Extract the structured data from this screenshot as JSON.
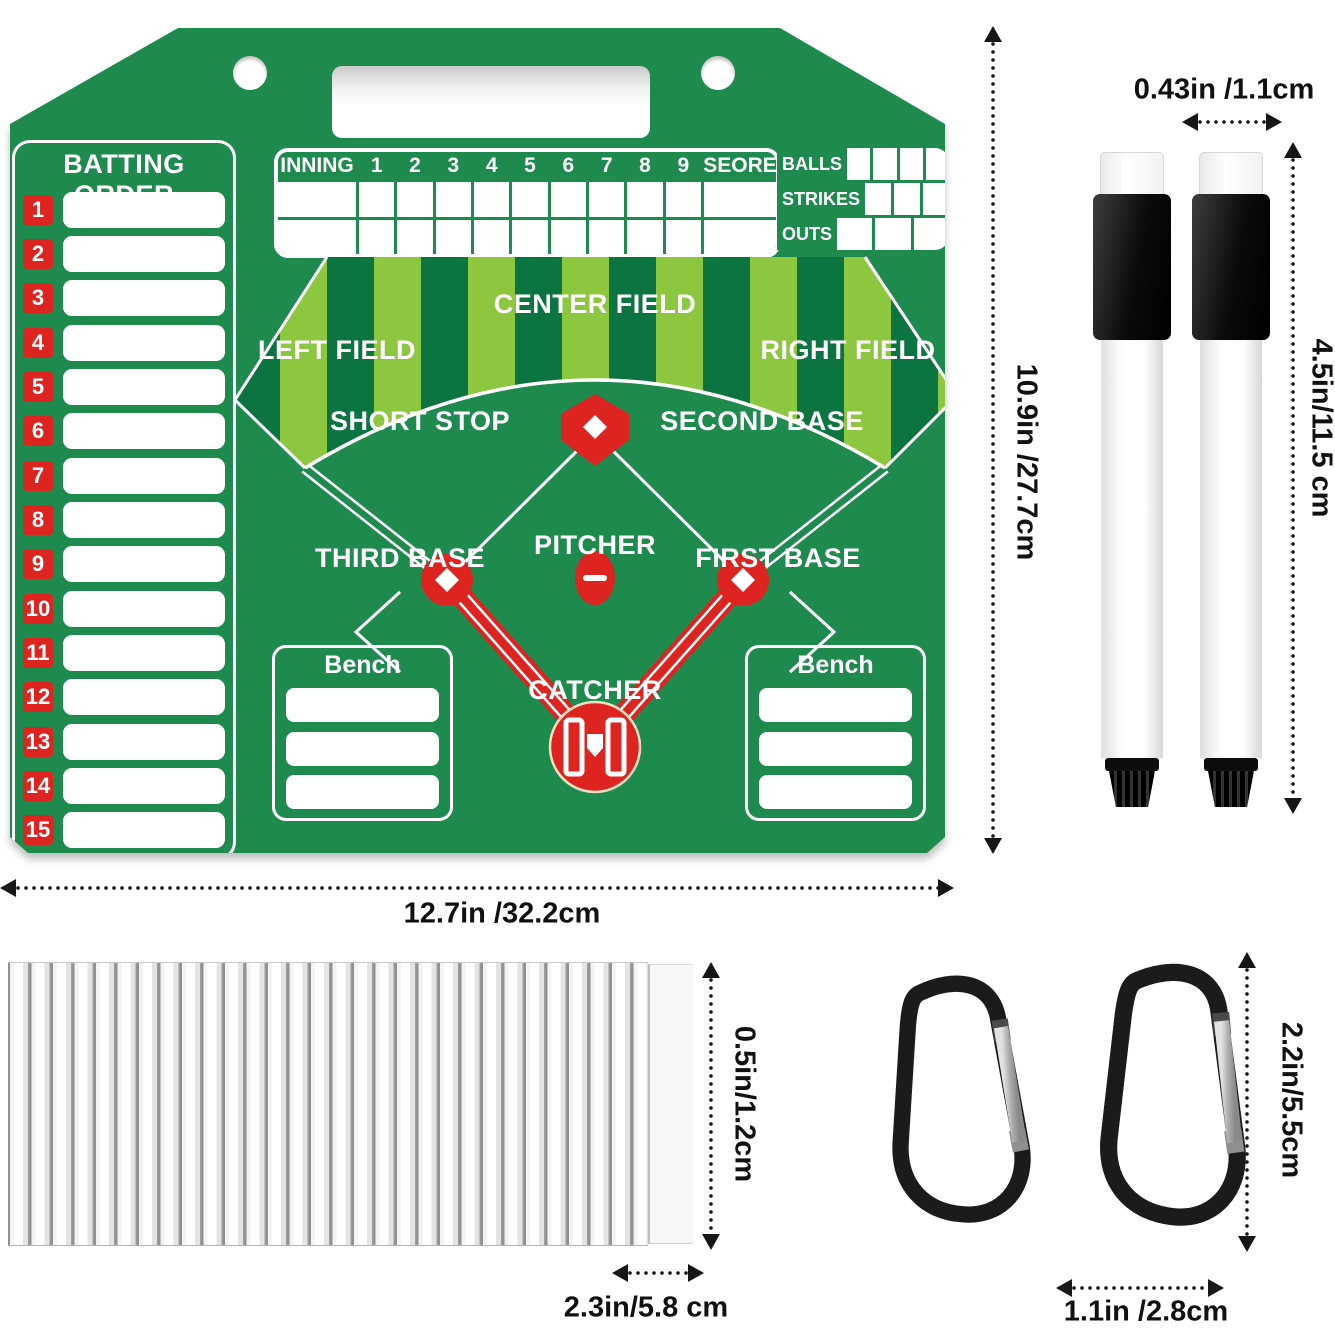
{
  "board": {
    "batting_order": {
      "title": "BATTING ORDER",
      "numbers": [
        "1",
        "2",
        "3",
        "4",
        "5",
        "6",
        "7",
        "8",
        "9",
        "10",
        "11",
        "12",
        "13",
        "14",
        "15"
      ]
    },
    "inning_table": {
      "header": [
        "INNING",
        "1",
        "2",
        "3",
        "4",
        "5",
        "6",
        "7",
        "8",
        "9",
        "SEORE"
      ],
      "body_rows": 2
    },
    "count_panel": {
      "rows": [
        {
          "label": "BALLS",
          "cells": 4
        },
        {
          "label": "STRIKES",
          "cells": 3
        },
        {
          "label": "OUTS",
          "cells": 3
        }
      ]
    },
    "field": {
      "labels": {
        "center_field": "CENTER FIELD",
        "left_field": "LEFT FIELD",
        "right_field": "RIGHT FIELD",
        "short_stop": "SHORT STOP",
        "second_base": "SECOND BASE",
        "pitcher": "PITCHER",
        "third_base": "THIRD BASE",
        "first_base": "FIRST BASE",
        "catcher": "CATCHER"
      }
    },
    "bench_left": {
      "title": "Bench",
      "slots": 3
    },
    "bench_right": {
      "title": "Bench",
      "slots": 3
    }
  },
  "annotations": {
    "board_height": "10.9in /27.7cm",
    "board_width": "12.7in /32.2cm",
    "marker_width": "0.43in /1.1cm",
    "marker_length": "4.5in/11.5 cm",
    "card_thickness": "0.5in/1.2cm",
    "card_width": "2.3in/5.8 cm",
    "carabiner_length": "2.2in/5.5cm",
    "carabiner_width": "1.1in /2.8cm"
  },
  "colors": {
    "board_green": "#1E8A4E",
    "stripe_dark": "#0B7440",
    "stripe_light": "#8DC63F",
    "accent_red": "#DE2420",
    "white": "#FFFFFF"
  }
}
